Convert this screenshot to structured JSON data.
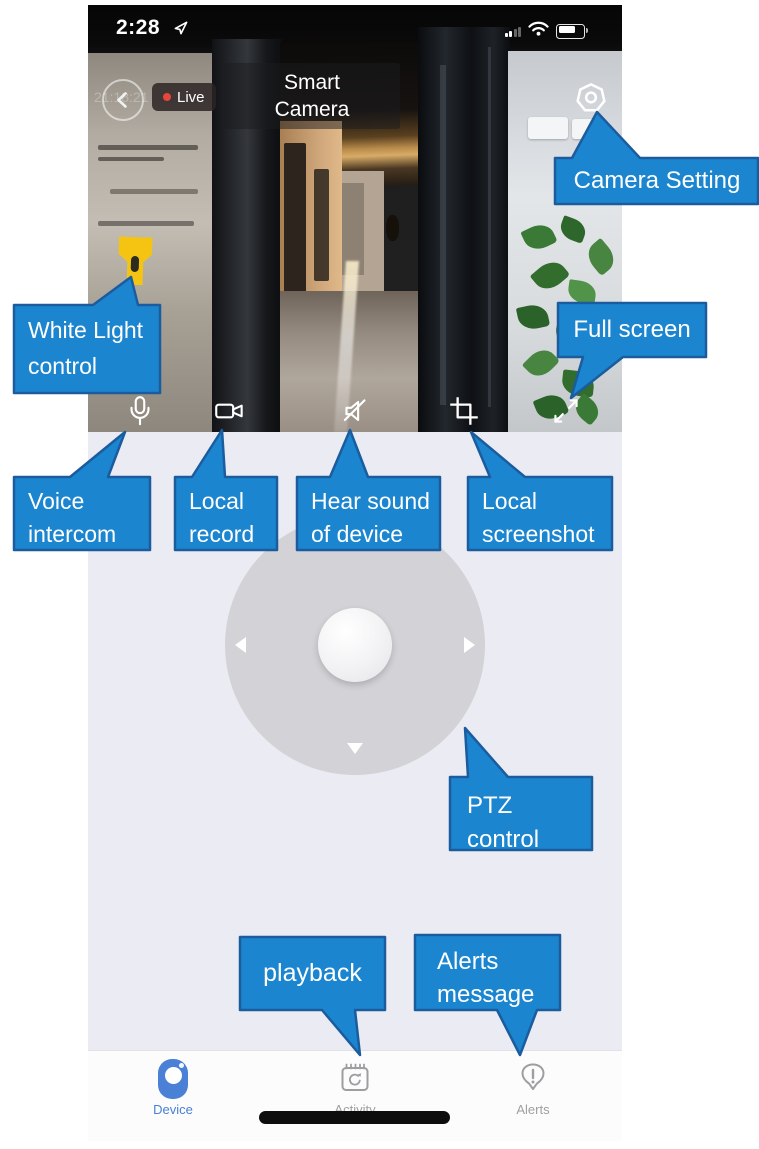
{
  "status_bar": {
    "time": "2:28"
  },
  "header": {
    "title_line1": "Smart",
    "title_line2": "Camera",
    "live_label": "Live"
  },
  "camera_view": {
    "timestamp_overlay": "21:18:21"
  },
  "callouts": {
    "camera_setting": {
      "line1": "Camera Setting"
    },
    "white_light": {
      "line1": "White Light",
      "line2": "control"
    },
    "full_screen": {
      "line1": "Full screen"
    },
    "voice_intercom": {
      "line1": "Voice",
      "line2": "intercom"
    },
    "local_record": {
      "line1": "Local",
      "line2": "record"
    },
    "hear_sound": {
      "line1": "Hear sound",
      "line2": "of device"
    },
    "local_screenshot": {
      "line1": "Local",
      "line2": "screenshot"
    },
    "ptz_control": {
      "line1": "PTZ",
      "line2": "control"
    },
    "playback": {
      "line1": "playback"
    },
    "alerts_message": {
      "line1": "Alerts",
      "line2": "message"
    }
  },
  "icons": {
    "status_bar": [
      "location-arrow-icon",
      "cellular-signal-icon",
      "wifi-icon",
      "battery-icon"
    ],
    "header": [
      "back-chevron-icon",
      "live-dot",
      "settings-gear-icon"
    ],
    "camera_overlay": [
      "flashlight-icon"
    ],
    "camera_controls": [
      "microphone-icon",
      "video-record-icon",
      "speaker-muted-icon",
      "crop-screenshot-icon",
      "fullscreen-expand-icon"
    ],
    "ptz": [
      "ptz-left-arrow",
      "ptz-right-arrow",
      "ptz-down-arrow",
      "ptz-up-arrow",
      "ptz-center-knob"
    ],
    "bottom_nav": [
      "device-camera-icon",
      "activity-calendar-icon",
      "alerts-exclamation-icon"
    ]
  },
  "bottom_nav": {
    "items": [
      {
        "label": "Device",
        "active": true
      },
      {
        "label": "Activity",
        "active": false
      },
      {
        "label": "Alerts",
        "active": false
      }
    ]
  },
  "colors": {
    "callout_fill": "#1b86cf",
    "callout_border": "#1a5c9e",
    "active_tab_blue": "#4a80d6",
    "inactive_tab_gray": "#a0a0a2",
    "app_background": "#ebebf4",
    "ptz_circle": "#d3d2d6",
    "flashlight_yellow": "#f5c412",
    "live_dot_red": "#e8453c"
  }
}
